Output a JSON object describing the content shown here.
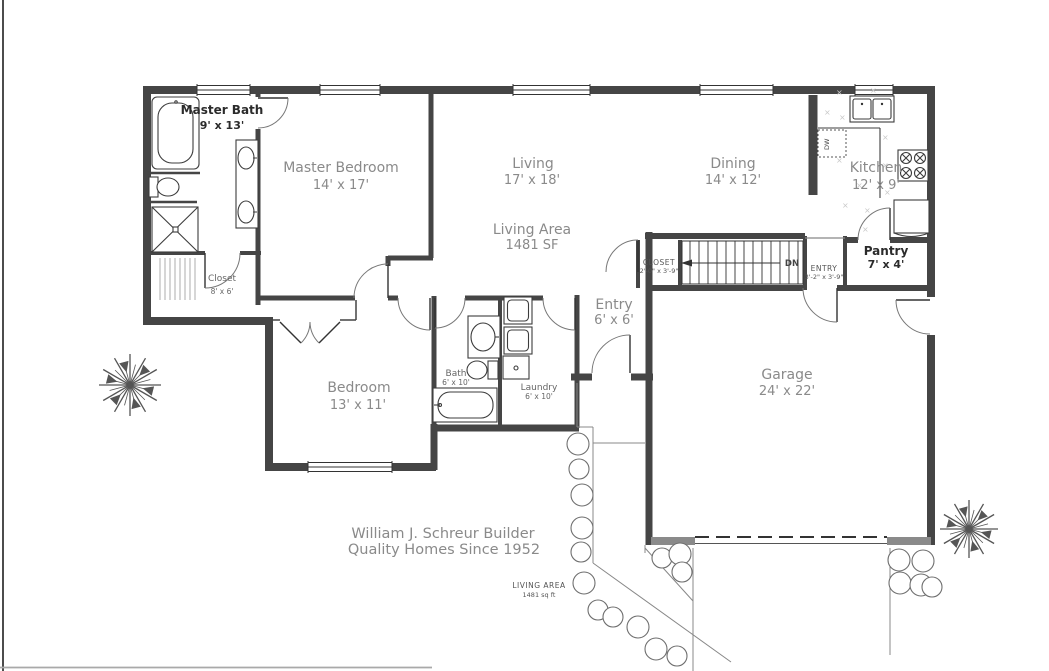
{
  "page": {
    "background": "#ffffff",
    "wall_color": "#454545",
    "label_color": "#8a8a8a",
    "bold_label_color": "#2b2b2b"
  },
  "title_block": {
    "builder_line1": "William J. Schreur Builder",
    "builder_line2": "Quality Homes Since 1952",
    "site_note_line1": "LIVING AREA",
    "site_note_line2": "1481 sq ft"
  },
  "summary": {
    "living_area_label": "Living Area",
    "living_area_value": "1481 SF"
  },
  "rooms": [
    {
      "name": "Master Bath",
      "dims": "9' x 13'"
    },
    {
      "name": "Master Bedroom",
      "dims": "14' x 17'"
    },
    {
      "name": "Living",
      "dims": "17' x 18'"
    },
    {
      "name": "Dining",
      "dims": "14' x 12'"
    },
    {
      "name": "Kitchen",
      "dims": "12' x 9'"
    },
    {
      "name": "Pantry",
      "dims": "7' x 4'"
    },
    {
      "name": "Closet",
      "dims": "8' x 6'"
    },
    {
      "name": "Bedroom",
      "dims": "13' x 11'"
    },
    {
      "name": "Bath",
      "dims": "6' x 10'"
    },
    {
      "name": "Laundry",
      "dims": "6' x 10'"
    },
    {
      "name": "Entry",
      "dims": "6' x 6'"
    },
    {
      "name": "Garage",
      "dims": "24' x 22'"
    },
    {
      "name": "CLOSET",
      "dims": "2'-0\" x 3'-9\""
    },
    {
      "name": "ENTRY",
      "dims": "3'-2\" x 3'-9\""
    }
  ],
  "annotations": {
    "stairs_direction": "DN",
    "dishwasher": "DW"
  }
}
